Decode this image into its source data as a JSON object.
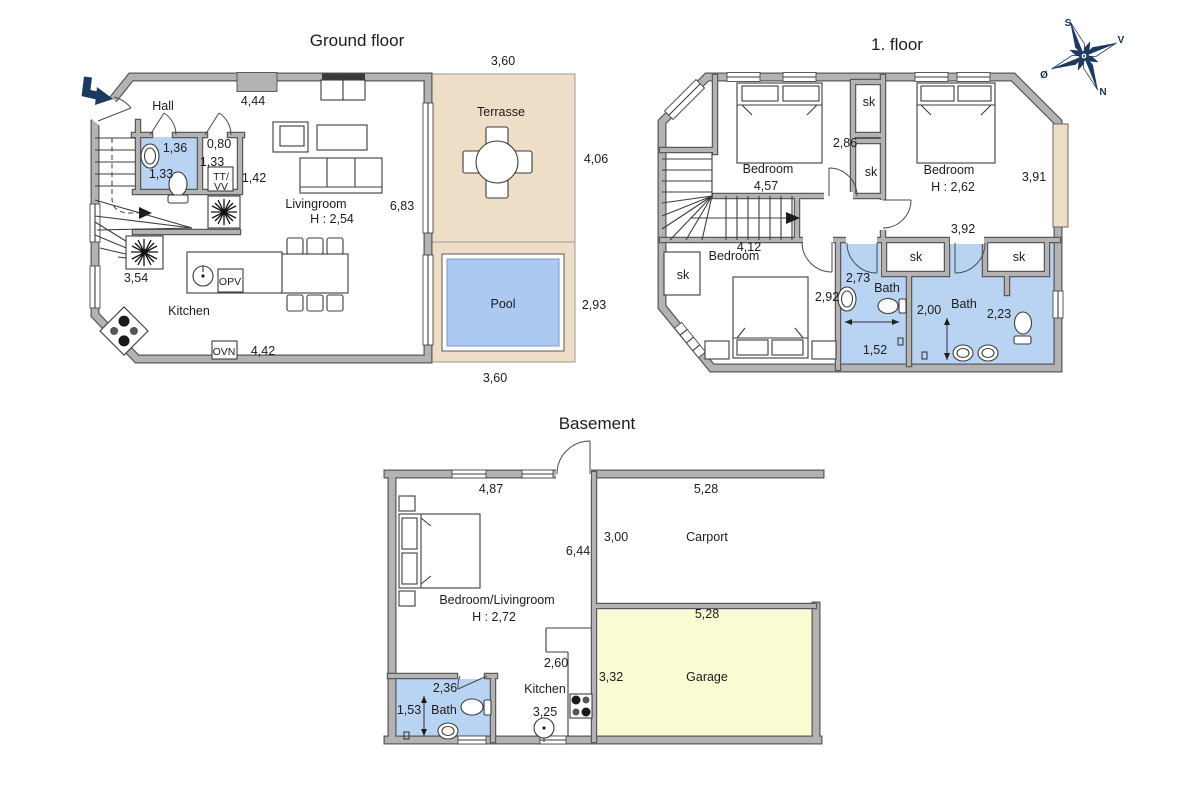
{
  "titles": {
    "ground": "Ground floor",
    "first": "1. floor",
    "basement": "Basement"
  },
  "compass": {
    "s": "S",
    "v": "V",
    "n": "N",
    "o": "Ø"
  },
  "colors": {
    "wall": "#b3b3b3",
    "wall_edge": "#5a5a5a",
    "bath": "#b9d3f2",
    "pool": "#abc9f1",
    "terrace": "#eeddc7",
    "garage": "#fafbd3",
    "navy": "#1d3a5e",
    "line": "#3d3d3d"
  },
  "ground": {
    "hall": "Hall",
    "top_dim": "4,44",
    "bath_w": "1,36",
    "bath_h": "1,33",
    "closet_w": "0,80",
    "closet_h": "1,33",
    "tt": "TT/",
    "vv": "VV",
    "hall_dim": "1,42",
    "stairs_dim": "3,54",
    "living": "Livingroom",
    "living_h": "H : 2,54",
    "living_side": "6,83",
    "kitchen": "Kitchen",
    "opv": "OPV",
    "ovn": "OVN",
    "bottom_dim": "4,42",
    "terrace": "Terrasse",
    "terrace_top": "3,60",
    "terrace_side": "4,06",
    "pool": "Pool",
    "pool_side": "2,93",
    "pool_bottom": "3,60"
  },
  "first": {
    "bedroom1": "Bedroom",
    "bedroom1_dim": "4,57",
    "mid_dim": "2,86",
    "bedroom2": "Bedroom",
    "bedroom2_h": "H : 2,62",
    "side_dim": "3,91",
    "wall_dim": "3,92",
    "bedroom3": "Bedroom",
    "bedroom3_top": "4,12",
    "bedroom3_side": "2,92",
    "sk": "sk",
    "bath1": "Bath",
    "bath1_w": "2,73",
    "bath1_h": "1,52",
    "bath2": "Bath",
    "bath2_w": "2,00",
    "bath2_side": "2,23"
  },
  "basement": {
    "room": "Bedroom/Livingroom",
    "room_h": "H : 2,72",
    "top_dim": "4,87",
    "mid_dim": "6,44",
    "bath": "Bath",
    "bath_top": "2,36",
    "bath_side": "1,53",
    "kitchen": "Kitchen",
    "kitchen_dim": "2,60",
    "kitchen_bottom": "3,25",
    "carport": "Carport",
    "carport_top": "5,28",
    "carport_side": "3,00",
    "garage": "Garage",
    "garage_top": "5,28",
    "garage_side": "3,32"
  }
}
